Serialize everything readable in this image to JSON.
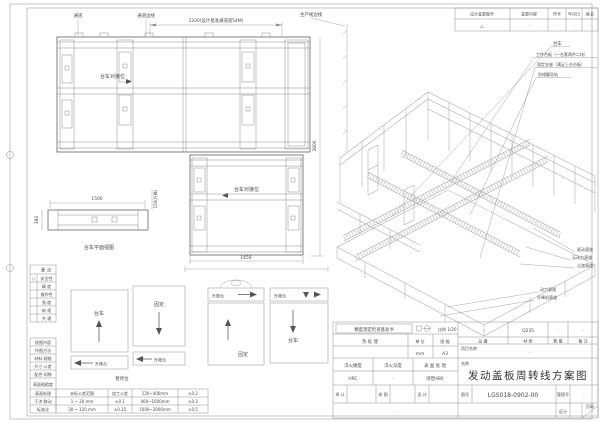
{
  "drawing": {
    "plan_top": {
      "passage": "通道",
      "passage_edge": "通道边线",
      "dim_width": "2200(设计基准通道宽54M)",
      "production_edge": "生产线边线",
      "dock": "台车对接位",
      "dim_height": "3800"
    },
    "plan_mid": {
      "dock": "台车对接位",
      "dim_bottom": "1650"
    },
    "side_view": {
      "dim_len": "1500",
      "dim_w": "380",
      "dim_lift": "150(升降)",
      "caption": "台车平面视图"
    },
    "iso": {
      "callouts_top": [
        "台车",
        "工件台板（一台套两件二块）",
        "固定支座（满足上台台板）",
        "防倾翻导轨"
      ],
      "callouts_mid": [
        "驱动滚道",
        "无动力滚道",
        "过渡滚道"
      ],
      "callouts_bottom": [
        "动力滚道",
        "升降机滚道"
      ]
    },
    "station_diagram": {
      "boxes": [
        {
          "label": "台车",
          "sub": "升降台"
        },
        {
          "label": "固定",
          "sub": "升降台"
        },
        {
          "top": "升降台",
          "label": "固定"
        },
        {
          "top": "升降台",
          "label": "台车"
        }
      ],
      "caption": "暂停位"
    }
  },
  "revision_table": {
    "headers": [
      "设计变更图号",
      "变更内容",
      "符号",
      "年月日",
      "姓名"
    ],
    "values": [
      "△",
      "·",
      "·",
      "·",
      "·"
    ]
  },
  "checklist": {
    "header1": "重  点",
    "rows1": [
      {
        "mark": "○",
        "label": "安全性"
      },
      {
        "mark": "",
        "label": "精  度"
      },
      {
        "mark": "",
        "label": "操作性"
      },
      {
        "mark": "",
        "label": "强  度"
      },
      {
        "mark": "",
        "label": "新  规"
      },
      {
        "mark": "",
        "label": "共  通"
      }
    ],
    "header2": "校图内容",
    "rows2": [
      "作图方法",
      "材料·规格",
      "尺寸·公差",
      "配合·间隙",
      "表面粗糙度",
      "表面处理",
      "干涉·移动",
      "标准化"
    ]
  },
  "tolerance_table": {
    "rows": [
      [
        "未标公差范围",
        "加工公差",
        "120~400mm",
        "±0.2"
      ],
      [
        "1 ~ 30 mm",
        "±0.1",
        "400~1000mm",
        "±0.3"
      ],
      [
        "30 ~ 120 mm",
        "±0.15",
        "1000~3000mm",
        "±0.5"
      ]
    ]
  },
  "title_block": {
    "check_title": "精度测定检查基准书",
    "scale_label": "比例",
    "scale_value": "1/20",
    "heat_label": "热  处  理",
    "unit_label": "单 位",
    "unit_value": "mm",
    "format_label": "图 幅",
    "format_value": "A3",
    "part_label": "品 番",
    "part_value": "·",
    "material_label": "材 质",
    "material_value": "Q235",
    "qty_label": "数 量",
    "qty_value": "·",
    "note_label": "备 注",
    "note_value": "·",
    "project_label": "项目名称",
    "project_value": "·",
    "hardness_label": "淬火硬度",
    "hardness_value": "HRC",
    "depth_label": "淬火深度",
    "depth_value": "·",
    "surface_label": "表 面 处 理",
    "surface_value": "喷塑480",
    "name_label": "名称",
    "drawing_title": "发动盖板周转线方案图",
    "approve_label": "承 认",
    "review_label": "校 图",
    "design_label": "设 计",
    "dwgno_label": "图号",
    "dwgno_value": "LGS018-0902-00",
    "mgmt_label": "管理号",
    "mgmt_value": "·",
    "class_label": "区分",
    "class_value": "·",
    "page_label": "页码",
    "bottom_note": "·"
  }
}
